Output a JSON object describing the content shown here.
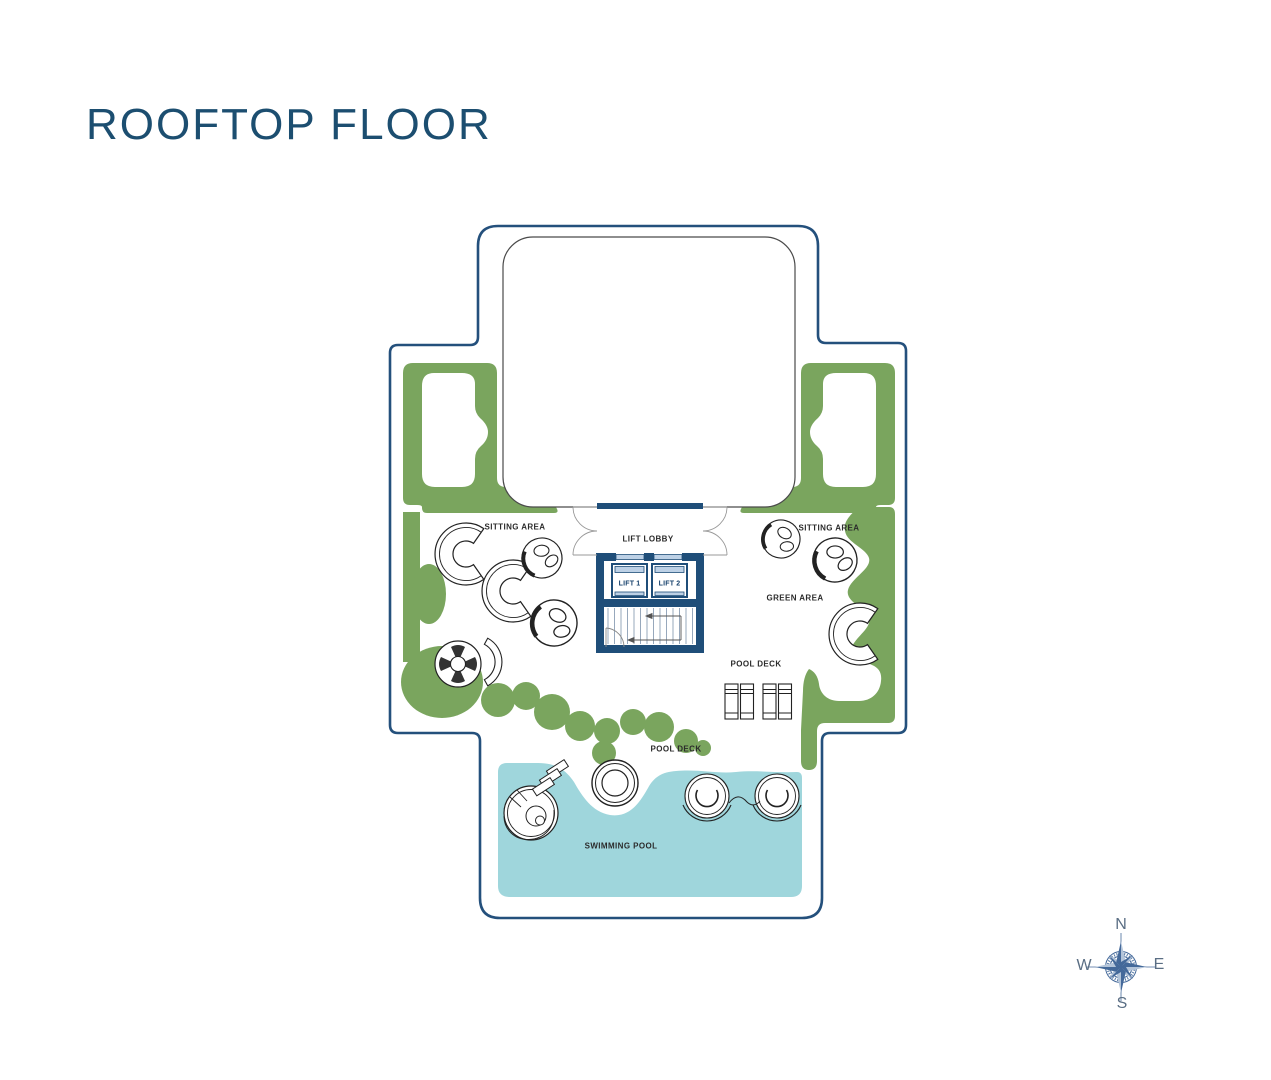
{
  "page": {
    "title": "ROOFTOP FLOOR"
  },
  "plan": {
    "labels": {
      "sitting_area_left": "SITTING AREA",
      "sitting_area_right": "SITTING AREA",
      "lift_lobby": "LIFT LOBBY",
      "green_area": "GREEN AREA",
      "pool_deck_upper": "POOL DECK",
      "pool_deck_lower": "POOL DECK",
      "swimming_pool": "SWIMMING POOL"
    },
    "lifts": {
      "lift_1": "LIFT 1",
      "lift_2": "LIFT 2"
    }
  },
  "compass": {
    "north": "N",
    "east": "E",
    "south": "S",
    "west": "W"
  },
  "colors": {
    "title_blue": "#1c4e70",
    "outline_blue": "#24507c",
    "wall_navy": "#1f4e79",
    "green": "#7aa55e",
    "pool_teal": "#9fd6dc",
    "lift_door_blue": "#bdd1e6",
    "compass_dark": "#44699a",
    "compass_light": "#b3c4d9",
    "label_dark": "#2b2b2b"
  }
}
